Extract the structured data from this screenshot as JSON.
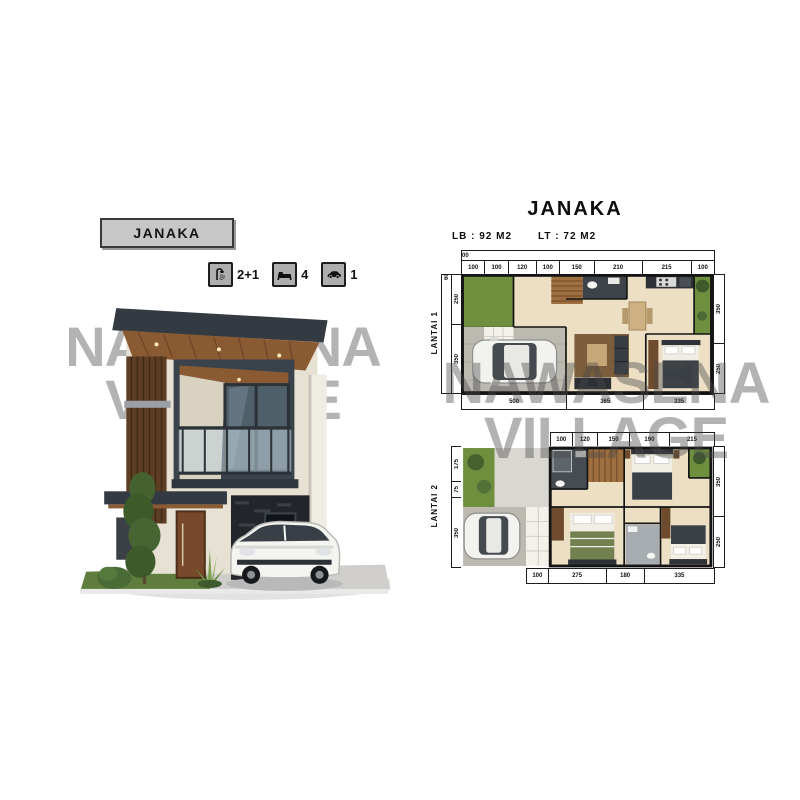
{
  "watermark": {
    "line1": "NAWASENA",
    "line2": "VILLAGE"
  },
  "left_panel": {
    "name_tag": "JANAKA",
    "features": [
      {
        "icon": "shower-icon",
        "label": "2+1"
      },
      {
        "icon": "bed-icon",
        "label": "4"
      },
      {
        "icon": "car-icon",
        "label": "1"
      }
    ]
  },
  "right_panel": {
    "title": "JANAKA",
    "building_area": "LB : 92 M2",
    "land_area": "LT : 72 M2",
    "plans": [
      {
        "label": "LANTAI 1",
        "top_total": "1200",
        "top_dims": [
          "100",
          "100",
          "120",
          "100",
          "150",
          "210",
          "215",
          "100"
        ],
        "left_total": "600",
        "left_dims": [
          "250",
          "350"
        ],
        "right_dims": [
          "350",
          "250"
        ],
        "bottom_dims": [
          "500",
          "365",
          "335"
        ]
      },
      {
        "label": "LANTAI 2",
        "top_dims": [
          "100",
          "120",
          "150",
          "190",
          "215"
        ],
        "left_dims": [
          "175",
          "75",
          "350"
        ],
        "right_dims": [
          "350",
          "250"
        ],
        "bottom_dims": [
          "100",
          "275",
          "180",
          "335"
        ]
      }
    ]
  },
  "colors": {
    "charcoal": "#343b42",
    "wood": "#8a5a33",
    "grass_green": "#6d8f3e",
    "floor_beige": "#ecdfc4",
    "tag_gray": "#c7c7c7",
    "stone_dark": "#22262b"
  }
}
